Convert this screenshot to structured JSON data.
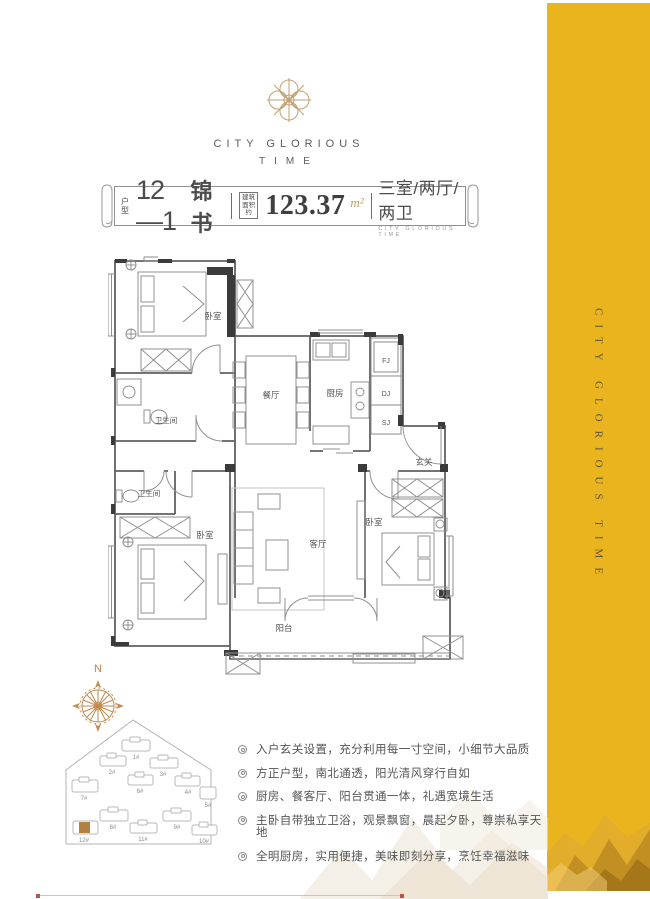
{
  "colors": {
    "band_yellow": "#EAB41E",
    "gold_accent": "#C2A075",
    "text_dark": "#4C4C4C"
  },
  "brand": {
    "name_line1": "CITY GLORIOUS",
    "name_line2": "TIME"
  },
  "side_band": {
    "vertical_text": "CITY GLORIOUS TIME"
  },
  "title_bar": {
    "unit_label_chars": [
      "户",
      "型"
    ],
    "unit_number": "12—1",
    "unit_name": "锦书",
    "area_label_lines": [
      "建筑",
      "面积约"
    ],
    "area_value": "123.37",
    "area_unit": "m²",
    "rooms_summary": "三室/两厅/两卫",
    "rooms_summary_sub": "CITY GLORIOUS TIME"
  },
  "floor_plan": {
    "labels": {
      "bedroom_top": "卧室",
      "bath_top": "卫生间",
      "dining": "餐厅",
      "kitchen": "厨房",
      "shaft_fj": "FJ",
      "shaft_dj": "DJ",
      "shaft_sj": "SJ",
      "foyer": "玄关",
      "bath_master": "卫生间",
      "bedroom_master": "卧室",
      "living": "客厅",
      "bedroom_right": "卧室",
      "balcony": "阳台"
    }
  },
  "compass": {
    "north": "N"
  },
  "site_plan": {
    "highlighted_building": "12#",
    "buildings": [
      {
        "label": "1#"
      },
      {
        "label": "2#"
      },
      {
        "label": "3#"
      },
      {
        "label": "4#"
      },
      {
        "label": "5#"
      },
      {
        "label": "6#"
      },
      {
        "label": "7#"
      },
      {
        "label": "8#"
      },
      {
        "label": "9#"
      },
      {
        "label": "10#"
      },
      {
        "label": "11#"
      },
      {
        "label": "12#"
      }
    ]
  },
  "features": [
    "入户玄关设置，充分利用每一寸空间，小细节大品质",
    "方正户型，南北通透，阳光清风穿行自如",
    "厨房、餐客厅、阳台贯通一体，礼遇宽境生活",
    "主卧自带独立卫浴，观景飘窗，晨起夕卧，尊崇私享天地",
    "全明厨房，实用便捷，美味即刻分享，烹饪幸福滋味"
  ]
}
